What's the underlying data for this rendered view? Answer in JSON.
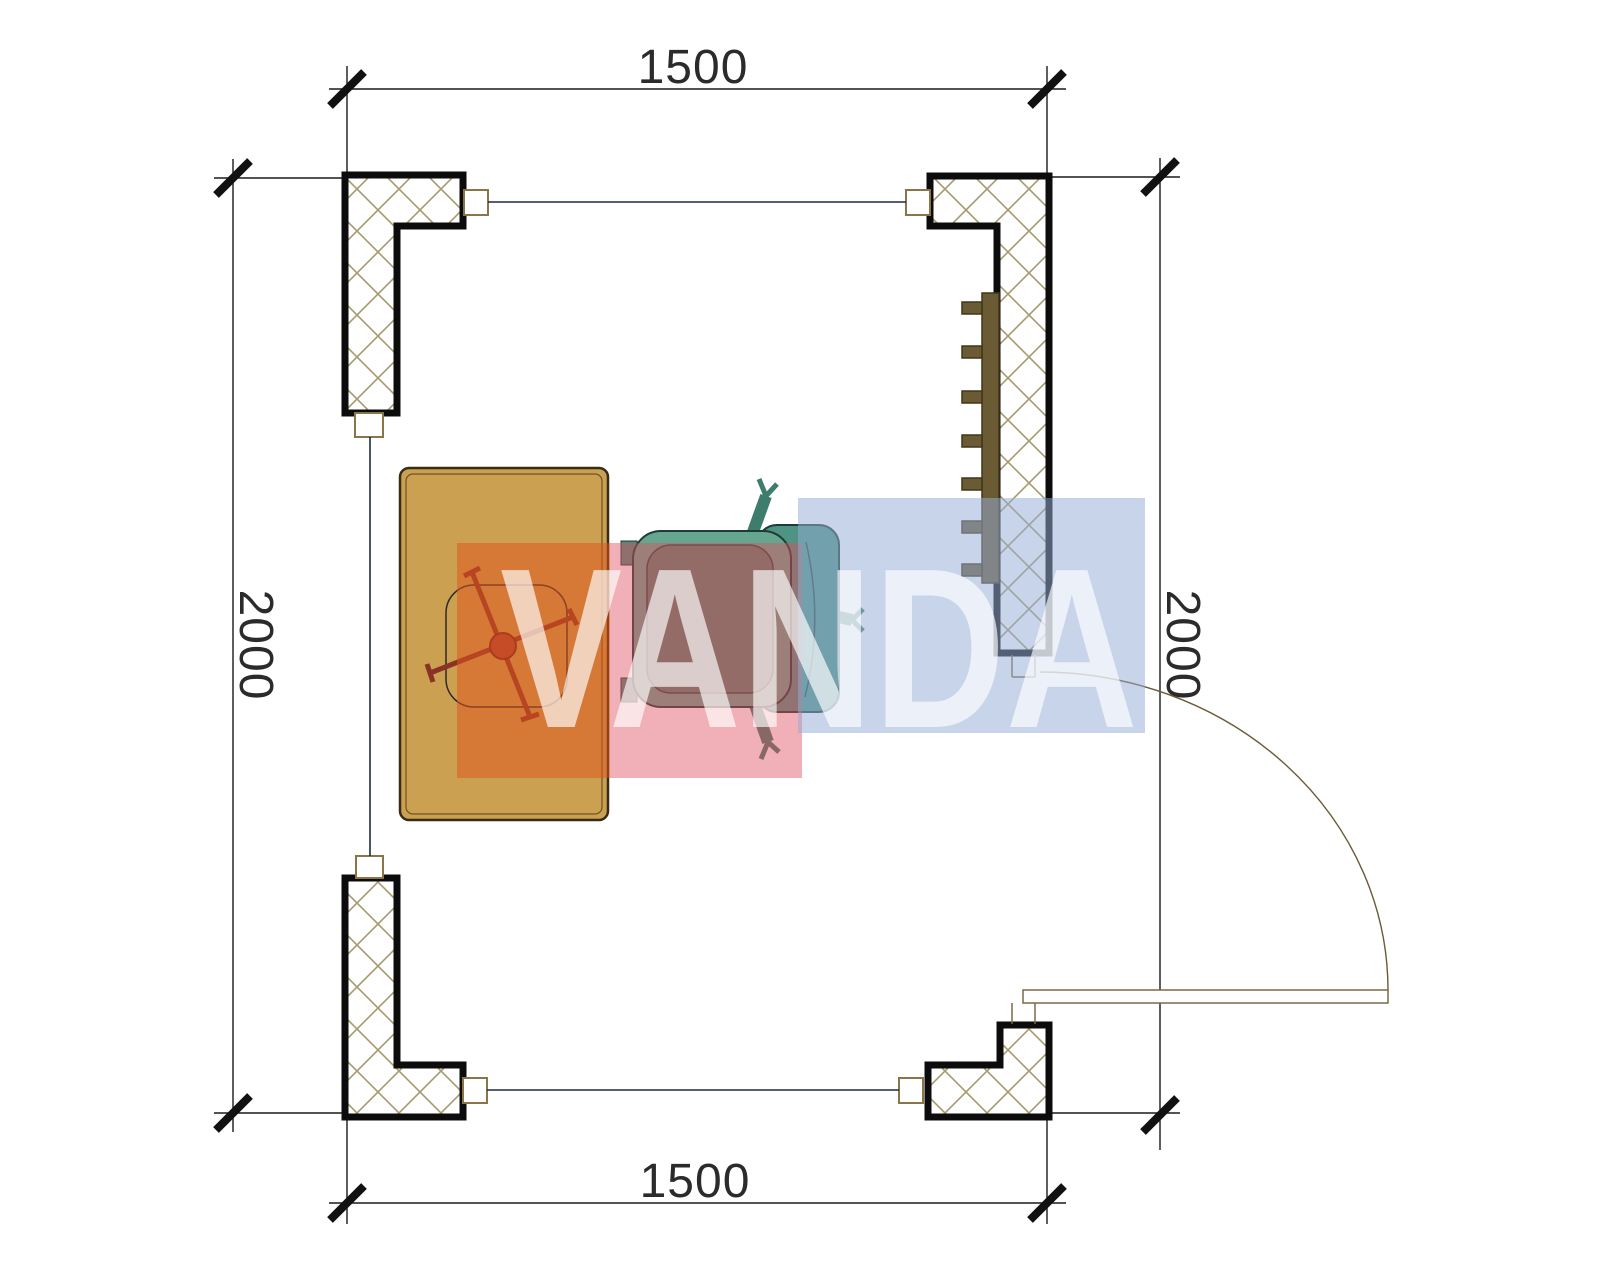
{
  "drawing": {
    "type": "architectural-floor-plan",
    "dimensions": {
      "top": "1500",
      "bottom": "1500",
      "left": "2000",
      "right": "2000"
    },
    "watermark": {
      "text": "VANDA",
      "block_colors": [
        "#E2571E",
        "#E0505F",
        "#96A8D4"
      ]
    },
    "colors": {
      "wall_outline": "#0c0c0c",
      "wall_hatch": "#A69A6E",
      "desk_fill": "#CBA050",
      "task_chair_base": "#8B3227",
      "armchair_fill": "#66A691",
      "radiator_fill": "#6B5B35",
      "door_line": "#7a6a45",
      "opening_line": "#1b2a4a",
      "dimension_text": "#2b2b2b"
    },
    "objects": [
      {
        "name": "desk"
      },
      {
        "name": "task-chair"
      },
      {
        "name": "armchair"
      },
      {
        "name": "radiator"
      },
      {
        "name": "door"
      }
    ]
  }
}
